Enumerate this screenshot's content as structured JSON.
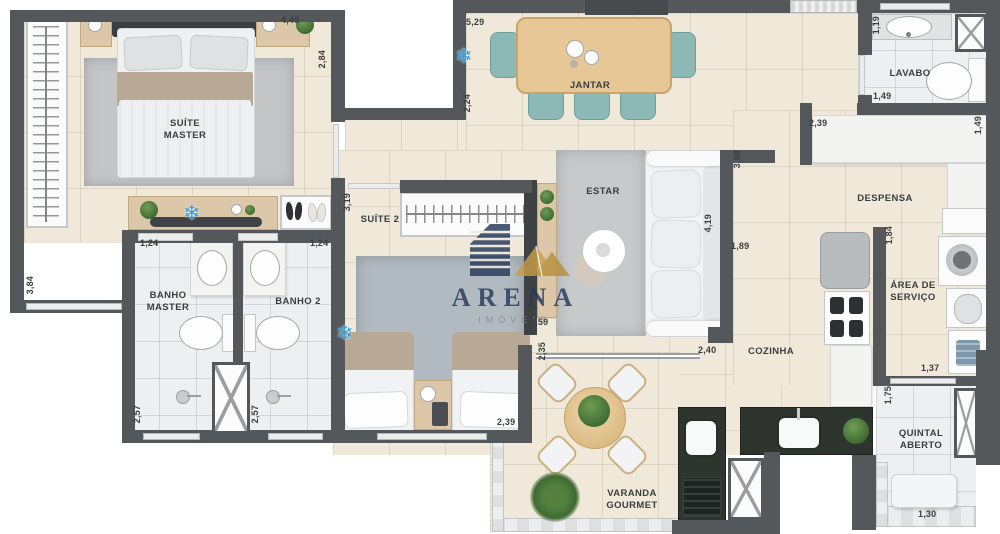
{
  "watermark": {
    "brand": "ARENA",
    "tagline": "IMÓVEIS"
  },
  "icons": {
    "ac": "❄"
  },
  "colors": {
    "wall": "#54585a",
    "floor": "#f0e9da",
    "bath_floor": "#edeff1",
    "wood": "#dcc8a8",
    "table_wood": "#e7c795",
    "chair_teal": "#8cb9b5",
    "counter_dark": "#2e342e",
    "ac_blue": "#2f9fe0",
    "brand_navy": "#24395c",
    "brand_gold": "#c79e4a"
  },
  "rooms": {
    "suite_master": "SUÍTE\nMASTER",
    "jantar": "JANTAR",
    "lavabo": "LAVABO",
    "despensa": "DESPENSA",
    "estar": "ESTAR",
    "suite2": "SUÍTE 2",
    "banho_master": "BANHO\nMASTER",
    "banho2": "BANHO 2",
    "cozinha": "COZINHA",
    "area_servico": "ÁREA DE\nSERVIÇO",
    "varanda_gourmet": "VARANDA\nGOURMET",
    "quintal_aberto": "QUINTAL\nABERTO"
  },
  "dims": [
    {
      "value": "4,49"
    },
    {
      "value": "2,84"
    },
    {
      "value": "3,84"
    },
    {
      "value": "1,24"
    },
    {
      "value": "1,24"
    },
    {
      "value": "5,29"
    },
    {
      "value": "2,24"
    },
    {
      "value": "1,19"
    },
    {
      "value": "1,49"
    },
    {
      "value": "2,39"
    },
    {
      "value": "1,49"
    },
    {
      "value": "1,84"
    },
    {
      "value": "3,19"
    },
    {
      "value": "3,88"
    },
    {
      "value": "4,19"
    },
    {
      "value": "1,89"
    },
    {
      "value": "2,59"
    },
    {
      "value": "2,35"
    },
    {
      "value": "2,39"
    },
    {
      "value": "2,57"
    },
    {
      "value": "2,57"
    },
    {
      "value": "2,40"
    },
    {
      "value": "1,37"
    },
    {
      "value": "1,75"
    },
    {
      "value": "1,30"
    }
  ]
}
